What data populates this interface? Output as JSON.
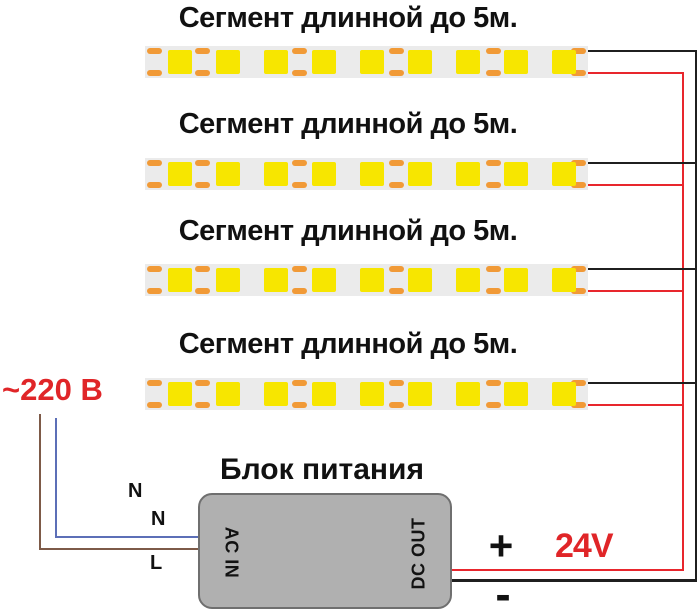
{
  "diagram": {
    "segment_title": "Сегмент длинной до 5м.",
    "segment_count": 4,
    "leds_per_segment": 9,
    "cut_marks_per_segment": 4,
    "psu": {
      "title": "Блок питания",
      "input_port_label": "AC IN",
      "output_port_label": "DC OUT"
    },
    "mains": {
      "voltage_label": "~220 В",
      "wire_labels": {
        "n1": "N",
        "n2": "N",
        "l": "L"
      }
    },
    "output": {
      "plus": "+",
      "minus": "-",
      "voltage": "24V"
    }
  },
  "colors": {
    "red": "#e8262d",
    "red_text": "#e02528",
    "wire_black": "#1f1f1f",
    "blue": "#5c6fb7",
    "brown": "#7d5a48",
    "strip_bg": "#ebebeb",
    "led_yellow": "#f7e600",
    "pad_orange": "#f19a37",
    "psu_fill": "#b0b0b0",
    "psu_border": "#6f6f6f",
    "text_black": "#111111"
  }
}
